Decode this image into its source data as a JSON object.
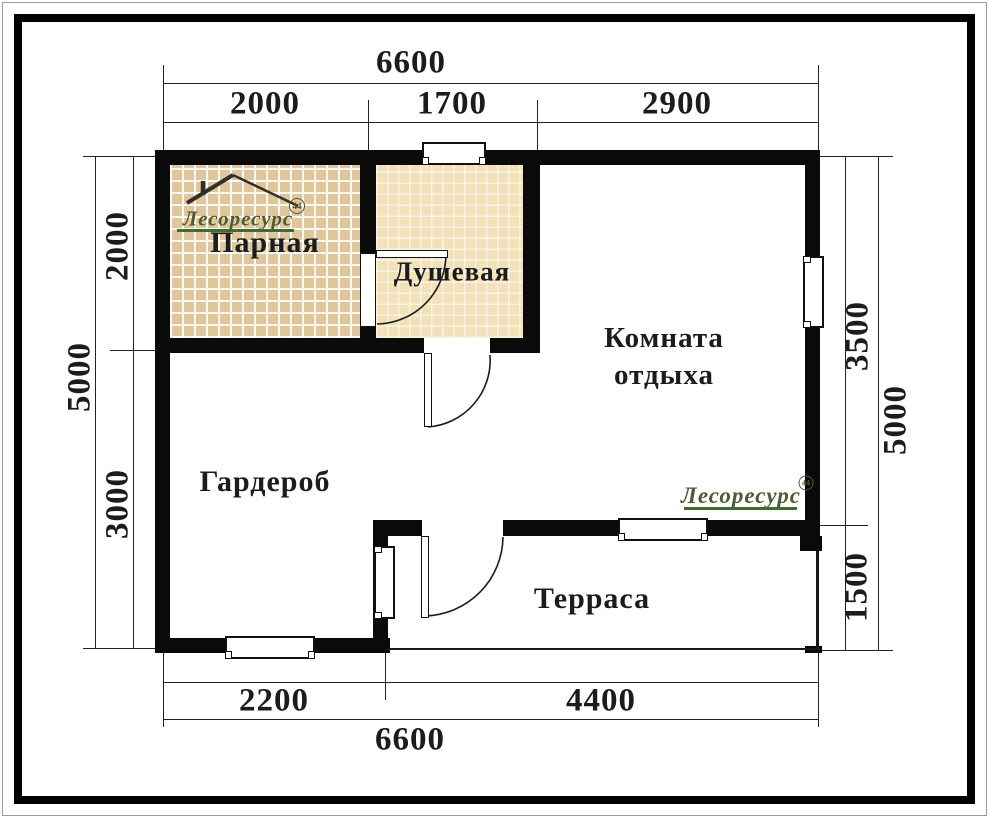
{
  "plan": {
    "rooms": [
      {
        "id": "parnaya",
        "label": "Парная"
      },
      {
        "id": "dushevaya",
        "label": "Душевая"
      },
      {
        "id": "komnata-otdyha",
        "label_line1": "Комната",
        "label_line2": "отдыха"
      },
      {
        "id": "garderob",
        "label": "Гардероб"
      },
      {
        "id": "terrasa",
        "label": "Терраса"
      }
    ],
    "dims": {
      "top": {
        "overall": "6600",
        "segments": [
          "2000",
          "1700",
          "2900"
        ]
      },
      "bottom": {
        "overall": "6600",
        "segments": [
          "2200",
          "4400"
        ]
      },
      "left": {
        "overall": "5000",
        "segments": [
          "2000",
          "3000"
        ]
      },
      "right": {
        "overall": "5000",
        "segments": [
          "3500",
          "1500"
        ]
      }
    },
    "logo": {
      "text": "Лесоресурс",
      "badge": "44"
    },
    "colors": {
      "wall": "#0a0a0a",
      "line": "#222222",
      "tile-parnaya": "#e0c69c",
      "tile-dushevaya": "#f3e1ba",
      "logo-text": "#4e5a33",
      "logo-underline": "#3f6b2e",
      "roof": "#33302a",
      "label": "#1c1c1c"
    }
  }
}
